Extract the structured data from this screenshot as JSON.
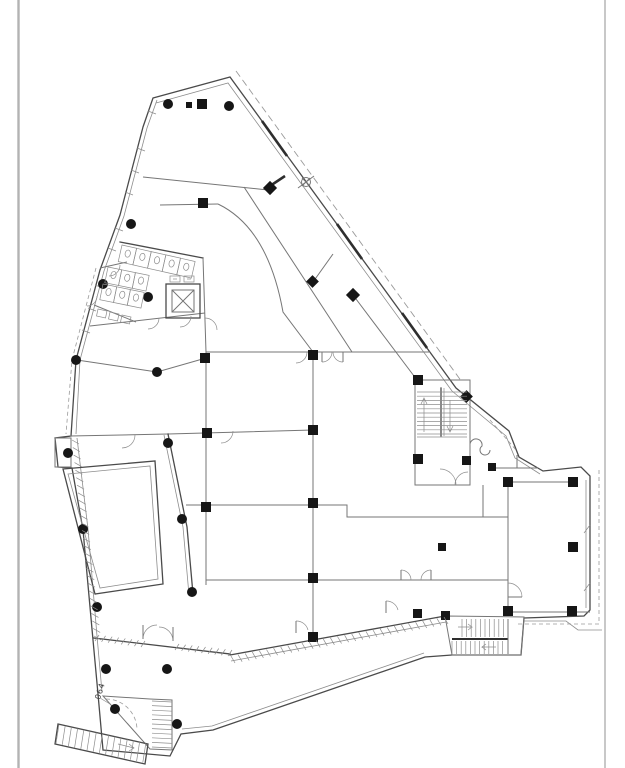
{
  "sheet": {
    "title": "architectural floor plan",
    "description": "CAD line drawing of an irregular triangular building floor plan with columns, stairs, elevator and toilet block"
  },
  "labels": {
    "room_number": "064"
  },
  "colors": {
    "paper": "#ffffff",
    "ink": "#4a4a4a",
    "mid": "#767676",
    "thin": "#8d8d8d",
    "dash": "#9a9a9a",
    "column": "#161616",
    "border": "#b3b3b3"
  }
}
